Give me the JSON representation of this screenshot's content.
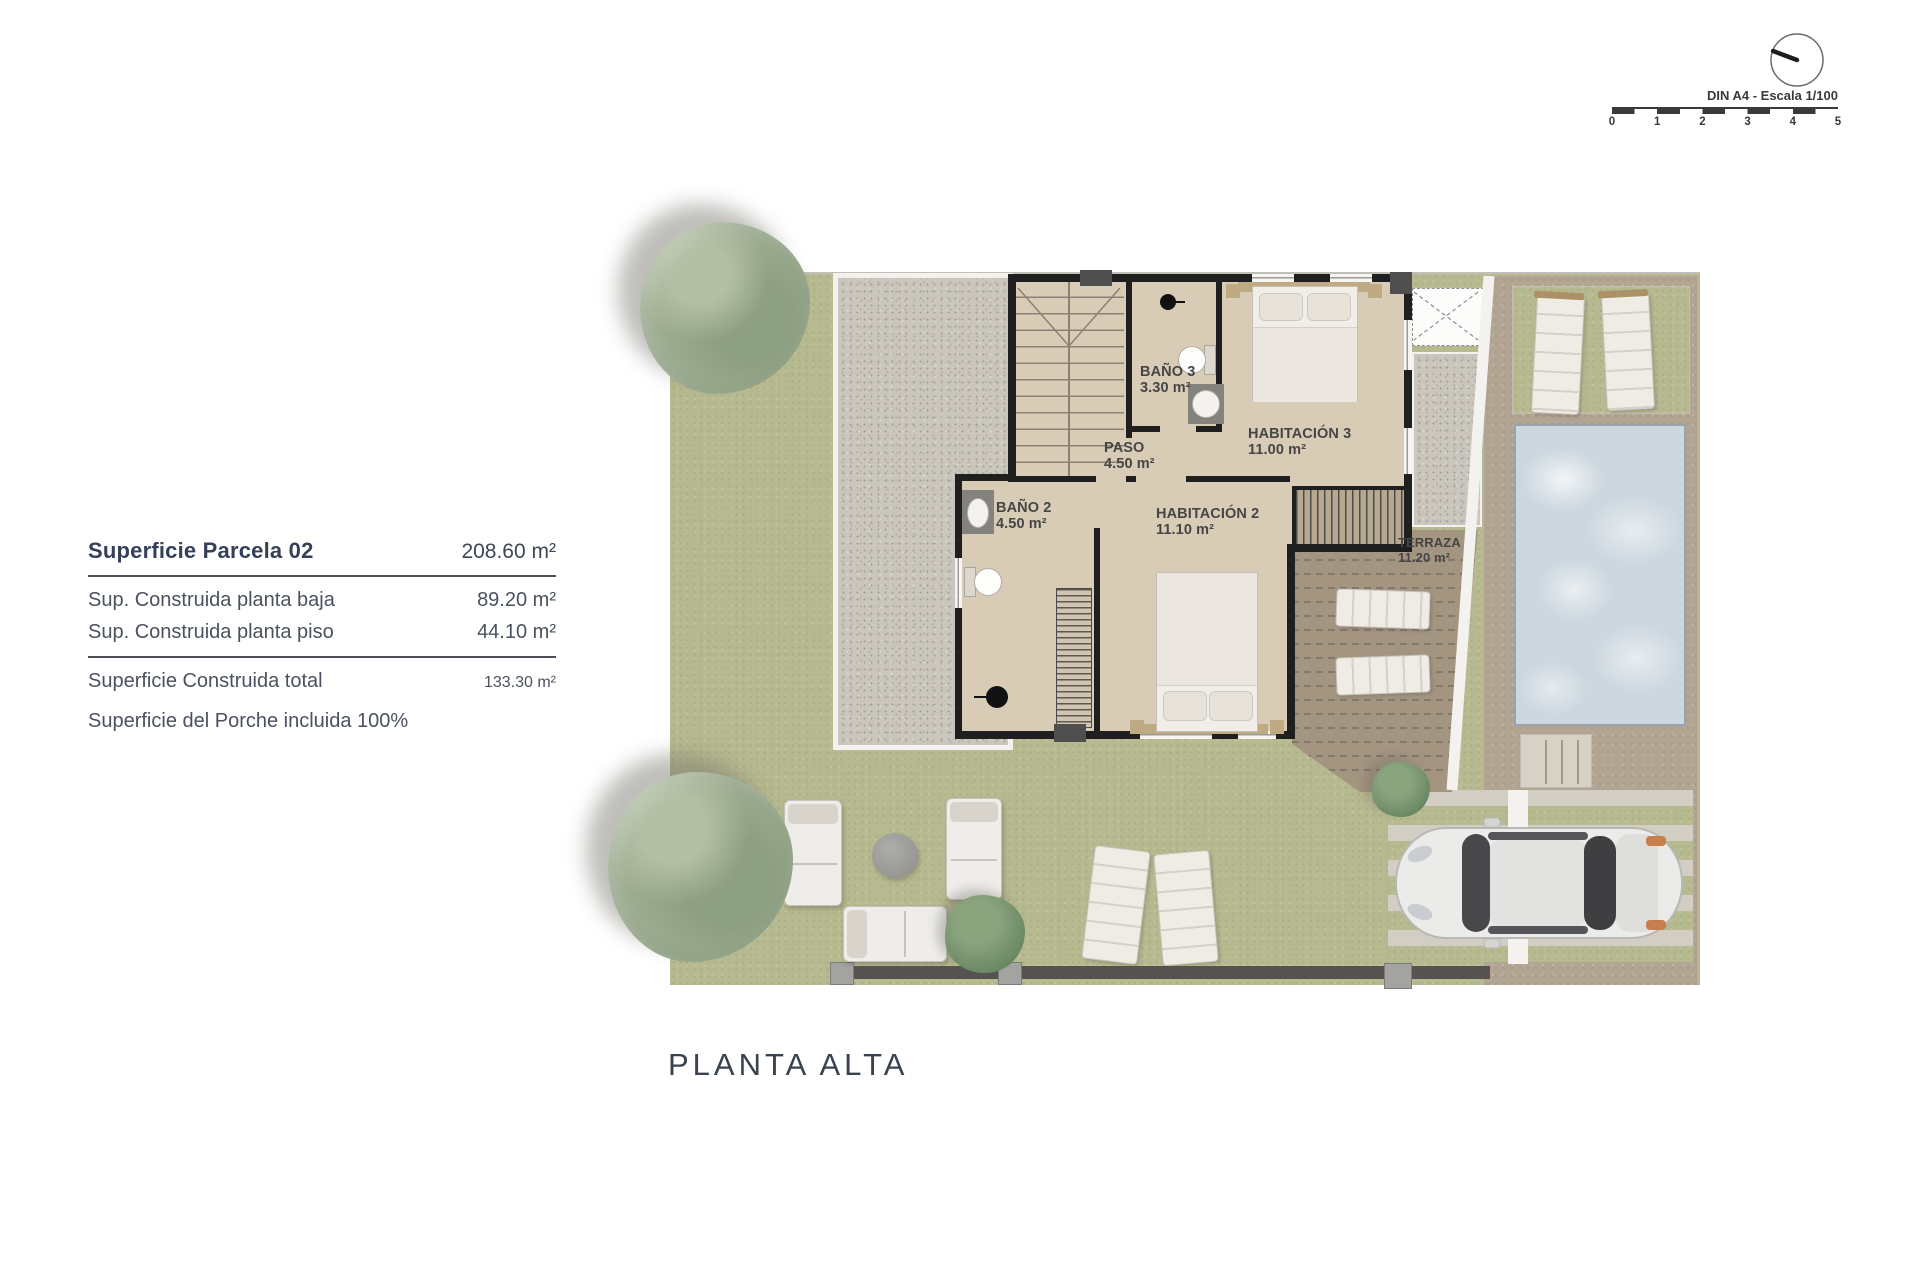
{
  "info_panel": {
    "title_label": "Superficie Parcela 02",
    "title_value": "208.60 m²",
    "rows": [
      {
        "label": "Sup. Construida planta baja",
        "value": "89.20 m²"
      },
      {
        "label": "Sup. Construida planta piso",
        "value": "44.10 m²"
      }
    ],
    "total_label": "Superficie Construida total",
    "total_value": "133.30 m²",
    "note": "Superficie del Porche incluida 100%"
  },
  "scale_bar": {
    "label": "DIN A4 - Escala 1/100",
    "ticks": [
      "0",
      "1",
      "2",
      "3",
      "4",
      "5"
    ]
  },
  "plan": {
    "title": "PLANTA ALTA",
    "rooms": [
      {
        "name": "BAÑO 3",
        "area": "3.30 m²"
      },
      {
        "name": "PASO",
        "area": "4.50 m²"
      },
      {
        "name": "HABITACIÓN 3",
        "area": "11.00 m²"
      },
      {
        "name": "BAÑO 2",
        "area": "4.50 m²"
      },
      {
        "name": "HABITACIÓN 2",
        "area": "11.10 m²"
      },
      {
        "name": "TERRAZA",
        "area": "11.20 m²"
      }
    ]
  },
  "colors": {
    "grass": "#b7ba90",
    "gravel": "#cac6be",
    "interior_floor": "#d9ccb7",
    "wall": "#1f1f1f",
    "terrace": "#a49581",
    "pool_water": "#ccd7df",
    "pool_deck": "#b3a594",
    "panel_text": "#3b445a",
    "plan_label_text": "#454545"
  }
}
